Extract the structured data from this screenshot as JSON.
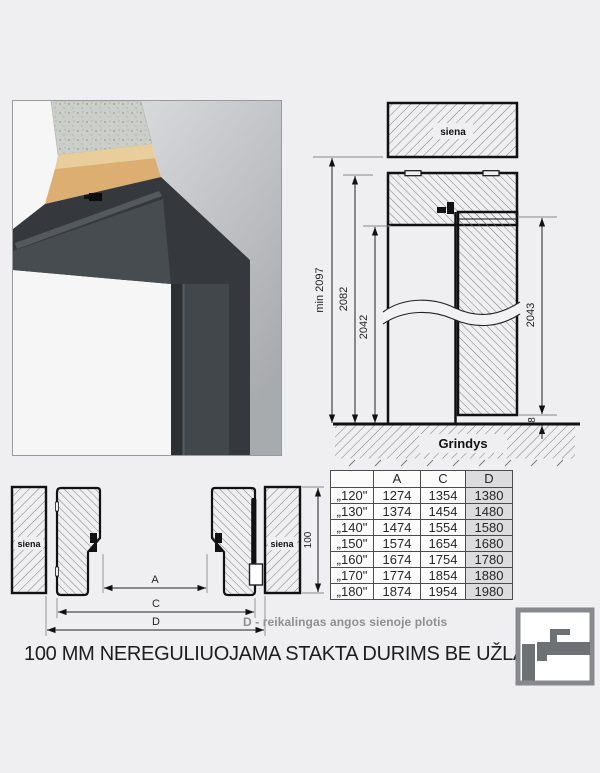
{
  "title": "100 MM NEREGULIUOJAMA STAKTA DURIMS BE UŽLAIDOS",
  "note": "D - reikalingas angos sienoje plotis",
  "photo": {
    "frame_color": "#35393d",
    "wall_color": "#b7babd",
    "plaster_color": "#dcae72",
    "concrete_color": "#cbcec9"
  },
  "section_drawing": {
    "wall_label": "siena",
    "floor_label": "Grindys",
    "dim_min_height": "min 2097",
    "dim_frame_height": "2082",
    "dim_opening_height": "2042",
    "dim_leaf_height": "2043",
    "dim_floor_gap": "8"
  },
  "plan_drawing": {
    "wall_label_left": "siena",
    "wall_label_right": "siena",
    "dim_a": "A",
    "dim_c": "C",
    "dim_d": "D",
    "dim_depth": "100"
  },
  "table": {
    "headers": [
      "",
      "A",
      "C",
      "D"
    ],
    "rows": [
      [
        "„120\"",
        "1274",
        "1354",
        "1380"
      ],
      [
        "„130\"",
        "1374",
        "1454",
        "1480"
      ],
      [
        "„140\"",
        "1474",
        "1554",
        "1580"
      ],
      [
        "„150\"",
        "1574",
        "1654",
        "1680"
      ],
      [
        "„160\"",
        "1674",
        "1754",
        "1780"
      ],
      [
        "„170\"",
        "1774",
        "1854",
        "1880"
      ],
      [
        "„180\"",
        "1874",
        "1954",
        "1980"
      ]
    ]
  }
}
